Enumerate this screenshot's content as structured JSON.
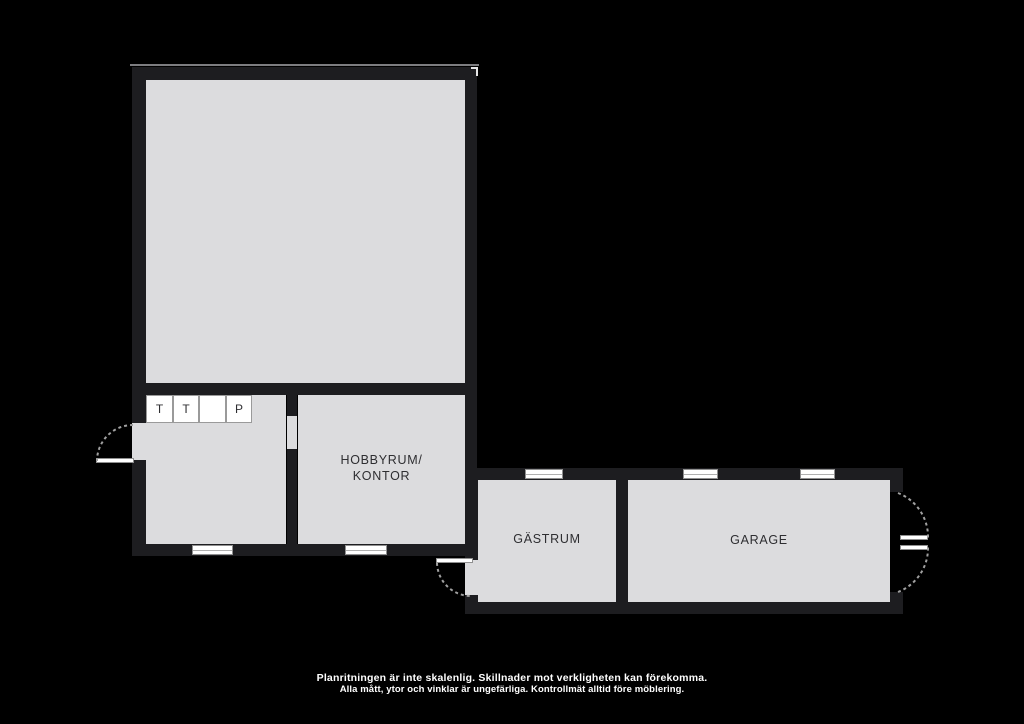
{
  "plan": {
    "rooms": {
      "hobbyrum": {
        "line1": "HOBBYRUM/",
        "line2": "KONTOR"
      },
      "gastrum": {
        "label": "GÄSTRUM"
      },
      "garage": {
        "label": "GARAGE"
      }
    },
    "closets": {
      "items": [
        "T",
        "T",
        "",
        "P"
      ]
    }
  },
  "footer": {
    "line1": "Planritningen är inte skalenlig. Skillnader mot verkligheten kan förekomma.",
    "line2": "Alla mått, ytor och vinklar är ungefärliga. Kontrollmät alltid före möblering."
  },
  "colors": {
    "background": "#000000",
    "wall": "#1d1d20",
    "floor": "#dcdcde",
    "symbol_white": "#ffffff",
    "symbol_outline": "#8f8f8f",
    "label_text": "#2e2e31",
    "footer_text": "#ffffff",
    "outer_outline": "#7d7d80"
  }
}
